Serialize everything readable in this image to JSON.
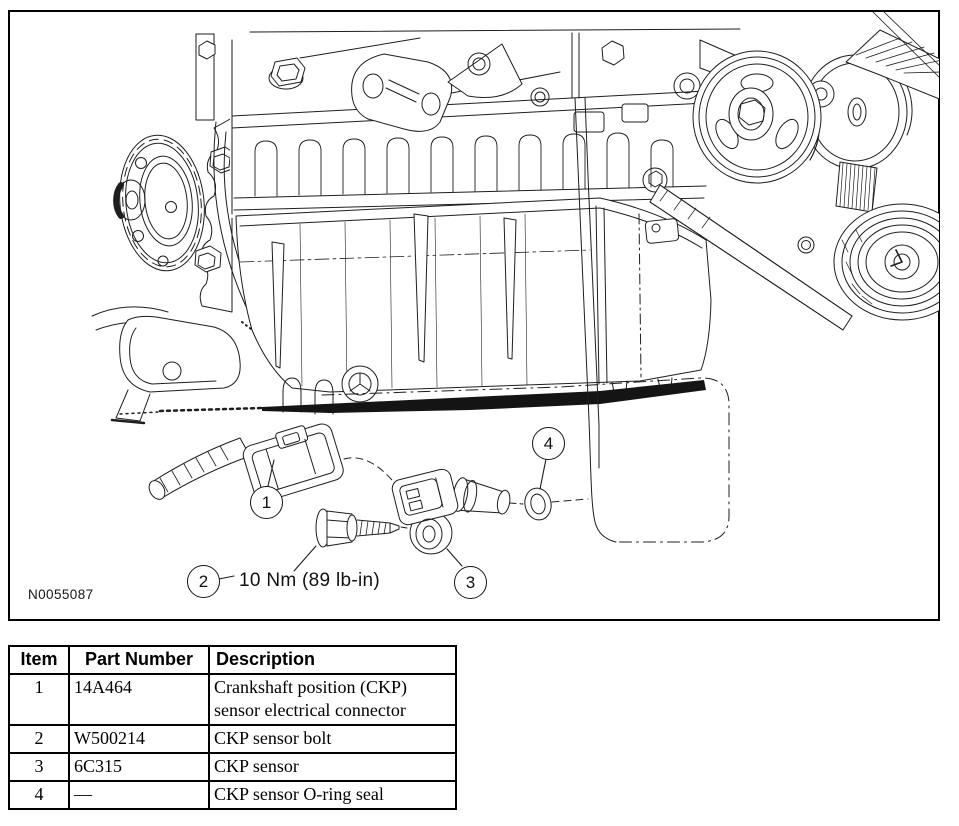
{
  "figure": {
    "figure_id": "N0055087",
    "torque_label": "10 Nm (89 lb-in)",
    "callouts": [
      {
        "number": "1",
        "target": "CKP sensor electrical connector"
      },
      {
        "number": "2",
        "target": "CKP sensor bolt"
      },
      {
        "number": "3",
        "target": "CKP sensor"
      },
      {
        "number": "4",
        "target": "CKP sensor O-ring seal"
      }
    ]
  },
  "parts_table": {
    "headers": {
      "item": "Item",
      "part_number": "Part Number",
      "description": "Description"
    },
    "rows": [
      {
        "item": "1",
        "part_number": "14A464",
        "description": "Crankshaft position (CKP) sensor electrical connector"
      },
      {
        "item": "2",
        "part_number": "W500214",
        "description": "CKP sensor bolt"
      },
      {
        "item": "3",
        "part_number": "6C315",
        "description": "CKP sensor"
      },
      {
        "item": "4",
        "part_number": "—",
        "description": "CKP sensor O-ring seal"
      }
    ]
  },
  "colors": {
    "line": "#1e1e1e",
    "background": "#ffffff",
    "border": "#000000"
  }
}
